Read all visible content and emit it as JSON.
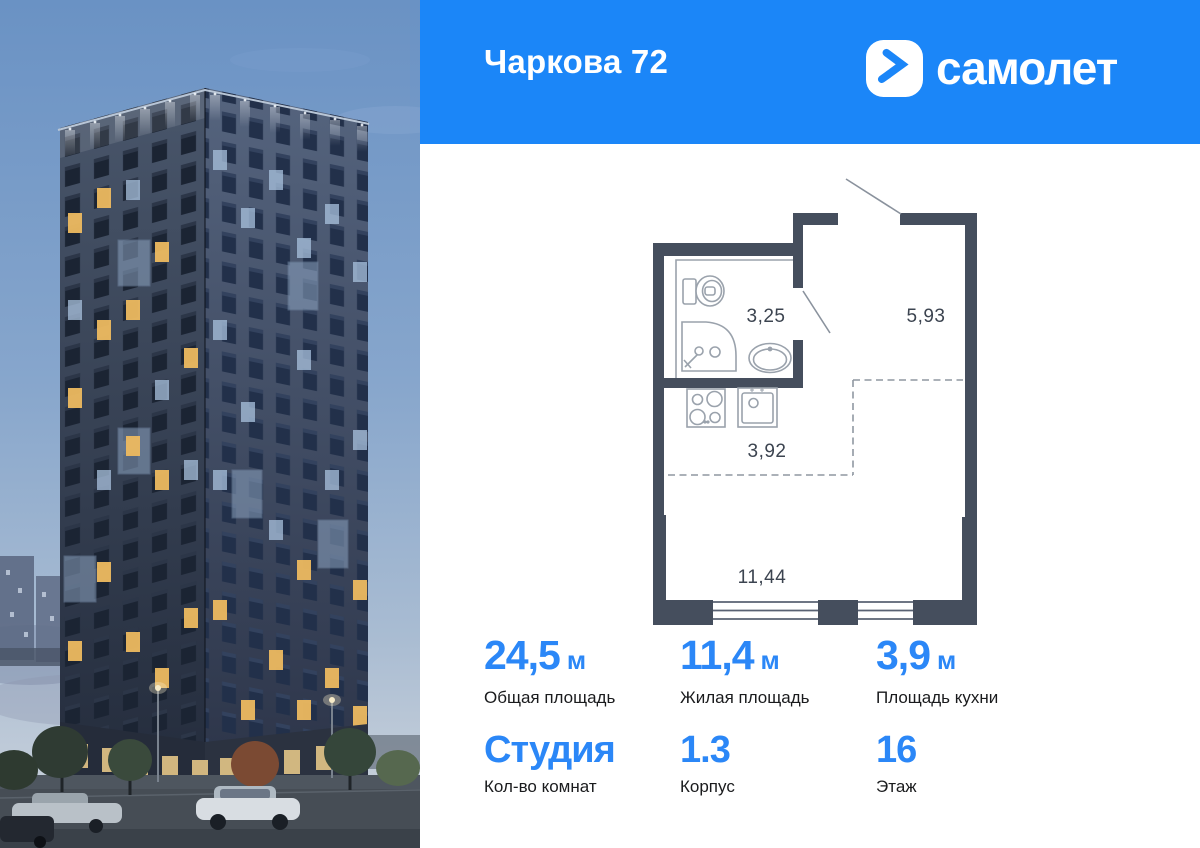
{
  "project": {
    "title": "Чаркова 72"
  },
  "brand": {
    "logo_text": "самолет",
    "icon": "samolet-chevron-icon"
  },
  "colors": {
    "header_bg": "#1B86F8",
    "accent_blue": "#2B87F7",
    "plan_wall": "#454E5D",
    "label_dark": "#1A1B1D"
  },
  "floor_plan": {
    "rooms": [
      {
        "name": "bathroom",
        "area": "3,25"
      },
      {
        "name": "hallway",
        "area": "5,93"
      },
      {
        "name": "kitchen-zone",
        "area": "3,92"
      },
      {
        "name": "living-room",
        "area": "11,44"
      }
    ],
    "fixtures": [
      "toilet",
      "shower",
      "sink",
      "hob",
      "kitchen-sink"
    ]
  },
  "stats": [
    {
      "value": "24,5",
      "unit": "м",
      "label": "Общая площадь"
    },
    {
      "value": "11,4",
      "unit": "м",
      "label": "Жилая площадь"
    },
    {
      "value": "3,9",
      "unit": "м",
      "label": "Площадь кухни"
    },
    {
      "value": "Студия",
      "unit": "",
      "label": "Кол-во комнат"
    },
    {
      "value": "1.3",
      "unit": "",
      "label": "Корпус"
    },
    {
      "value": "16",
      "unit": "",
      "label": "Этаж"
    }
  ]
}
